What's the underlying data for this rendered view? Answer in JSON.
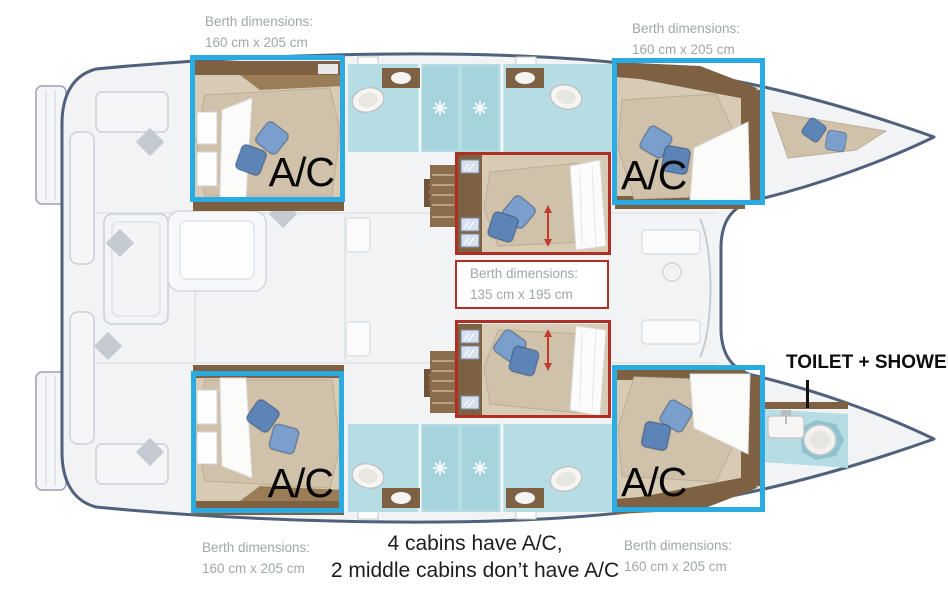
{
  "colors": {
    "highlight_blue": "#2aabe2",
    "highlight_red": "#b02f25",
    "label_gray": "#a1a6ab",
    "text_dark": "#1d1d1f",
    "hull_outline": "#51617c",
    "deck_fill": "#f1f3f5",
    "cabin_floor": "#d8cbb5",
    "wood": "#7e6043",
    "bathroom_teal": "#b7dde4",
    "pillow_blue": "#7a9fcd"
  },
  "berth_labels": [
    {
      "id": "top-left",
      "line1": "Berth dimensions:",
      "line2": "160 cm x 205 cm"
    },
    {
      "id": "top-right",
      "line1": "Berth dimensions:",
      "line2": "160 cm x 205 cm"
    },
    {
      "id": "bottom-left",
      "line1": "Berth dimensions:",
      "line2": "160 cm x 205 cm"
    },
    {
      "id": "bottom-right",
      "line1": "Berth dimensions:",
      "line2": "160 cm x 205 cm"
    }
  ],
  "middle_berth_box": {
    "line1": "Berth dimensions:",
    "line2": "135 cm x 195 cm"
  },
  "ac_cabins": [
    {
      "id": "aft-top",
      "label": "A/C"
    },
    {
      "id": "fwd-top",
      "label": "A/C"
    },
    {
      "id": "aft-bottom",
      "label": "A/C"
    },
    {
      "id": "fwd-bottom",
      "label": "A/C"
    }
  ],
  "toilet_shower": {
    "label": "TOILET + SHOWER"
  },
  "caption": {
    "line1": "4 cabins have A/C,",
    "line2": "2 middle cabins don’t have A/C"
  }
}
